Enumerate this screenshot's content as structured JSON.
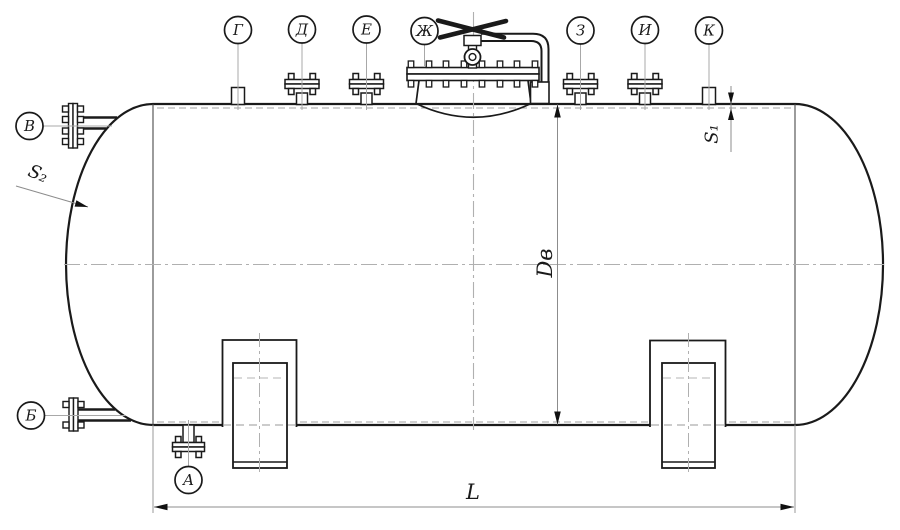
{
  "callouts": {
    "g": "Г",
    "d": "Д",
    "e": "Е",
    "zh": "Ж",
    "z": "З",
    "i": "И",
    "k": "К",
    "v": "В",
    "b": "Б",
    "a": "А"
  },
  "dimensions": {
    "length": "L",
    "inner_diameter": "Dв",
    "shell_thickness": "S₁",
    "head_thickness": "S₂"
  }
}
